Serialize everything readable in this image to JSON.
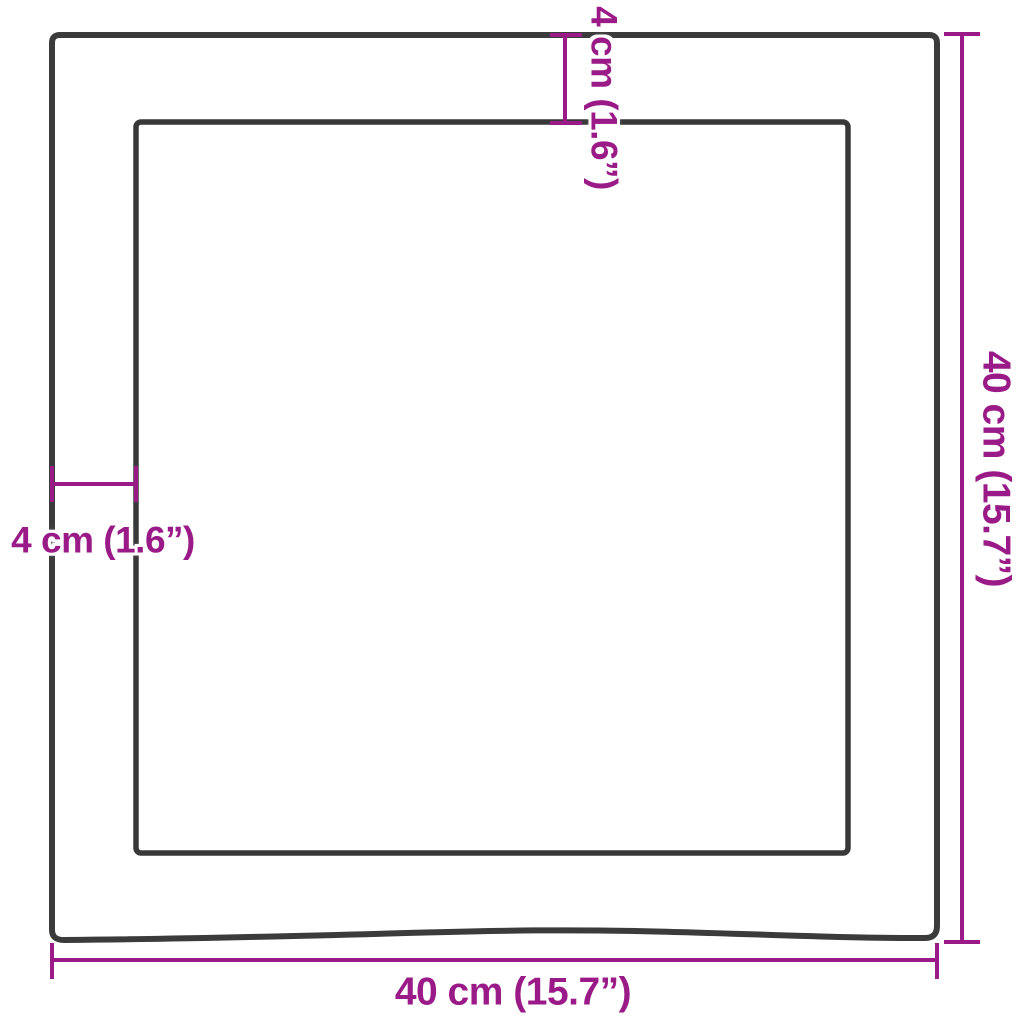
{
  "diagram": {
    "type": "product-dimension-diagram",
    "subject": "square-wood-panel-with-inner-recess-and-live-bottom-edge",
    "dimensions": {
      "border_top": {
        "value": "4 cm (1.6”)",
        "position": "top",
        "orientation": "vertical"
      },
      "border_left": {
        "value": "4 cm (1.6”)",
        "position": "left",
        "orientation": "horizontal"
      },
      "height": {
        "value": "40 cm (15.7”)",
        "position": "right",
        "orientation": "vertical"
      },
      "width": {
        "value": "40 cm (15.7”)",
        "position": "bottom",
        "orientation": "horizontal"
      }
    },
    "colors": {
      "dimension_accent": "#9A1B87",
      "board_edge": "#3B3B3B",
      "background": "#FFFFFF"
    }
  }
}
